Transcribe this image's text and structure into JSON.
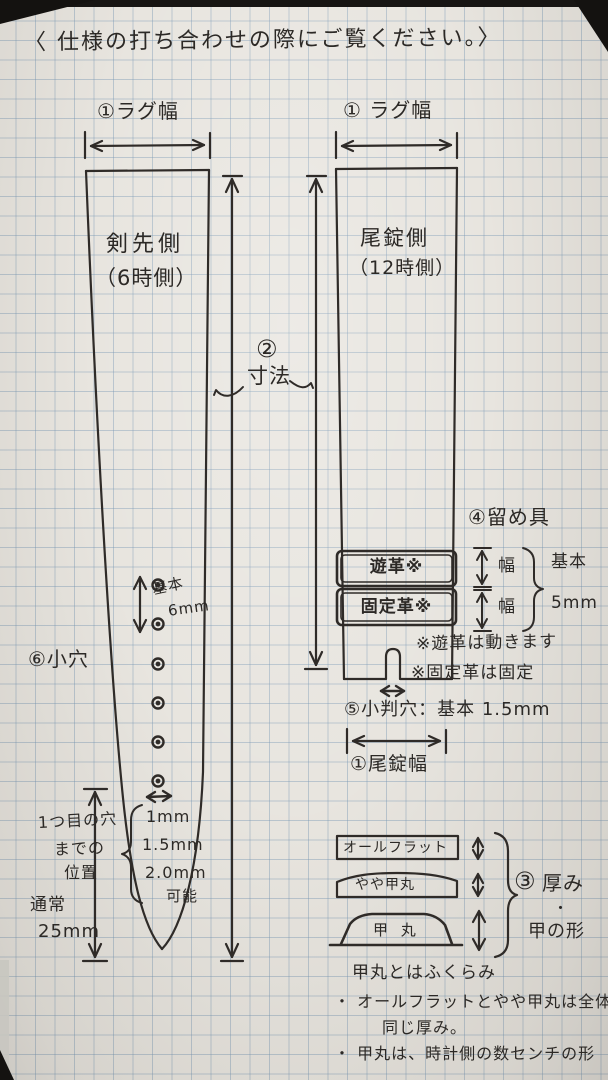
{
  "page": {
    "title": "〈 仕様の打ち合わせの際にご覧ください。〉"
  },
  "left_strap": {
    "lug_width_label": "①ラグ幅",
    "side_name": "剣先側",
    "side_sub": "（6時側）",
    "small_holes_label": "⑥小穴",
    "hole_pitch_line1": "基本",
    "hole_pitch_line2": "6mm",
    "hole_gap_sizes": [
      "1mm",
      "1.5mm",
      "2.0mm"
    ],
    "hole_gap_note": "可能",
    "first_hole_lines": [
      "1つ目の穴",
      "までの",
      "位置",
      "通常",
      "25mm"
    ]
  },
  "dimension": {
    "num": "②",
    "label": "寸法"
  },
  "right_strap": {
    "lug_width_label": "① ラグ幅",
    "side_name": "尾錠側",
    "side_sub": "（12時側）",
    "fastener_label": "④留め具",
    "keeper_loose": "遊革※",
    "keeper_fixed": "固定革※",
    "width_label_1": "幅",
    "width_label_2": "幅",
    "width_basic_1": "基本",
    "width_basic_2": "5mm",
    "note_loose": "※遊革は動きます",
    "note_fixed": "※固定革は固定",
    "oval_hole_label": "⑤小判穴：基本 1.5mm",
    "buckle_width_label": "①尾錠幅"
  },
  "cross_sections": {
    "flat": "オールフラット",
    "semi_dome": "やや甲丸",
    "dome": "甲 丸",
    "group_num": "③",
    "group_label_1": "厚み",
    "group_dot": "・",
    "group_label_2": "甲の形",
    "note_1": "甲丸とはふくらみ",
    "note_2": "・ オールフラットとやや甲丸は全体が",
    "note_3": "同じ厚み。",
    "note_4": "・ 甲丸は、時計側の数センチの形"
  }
}
